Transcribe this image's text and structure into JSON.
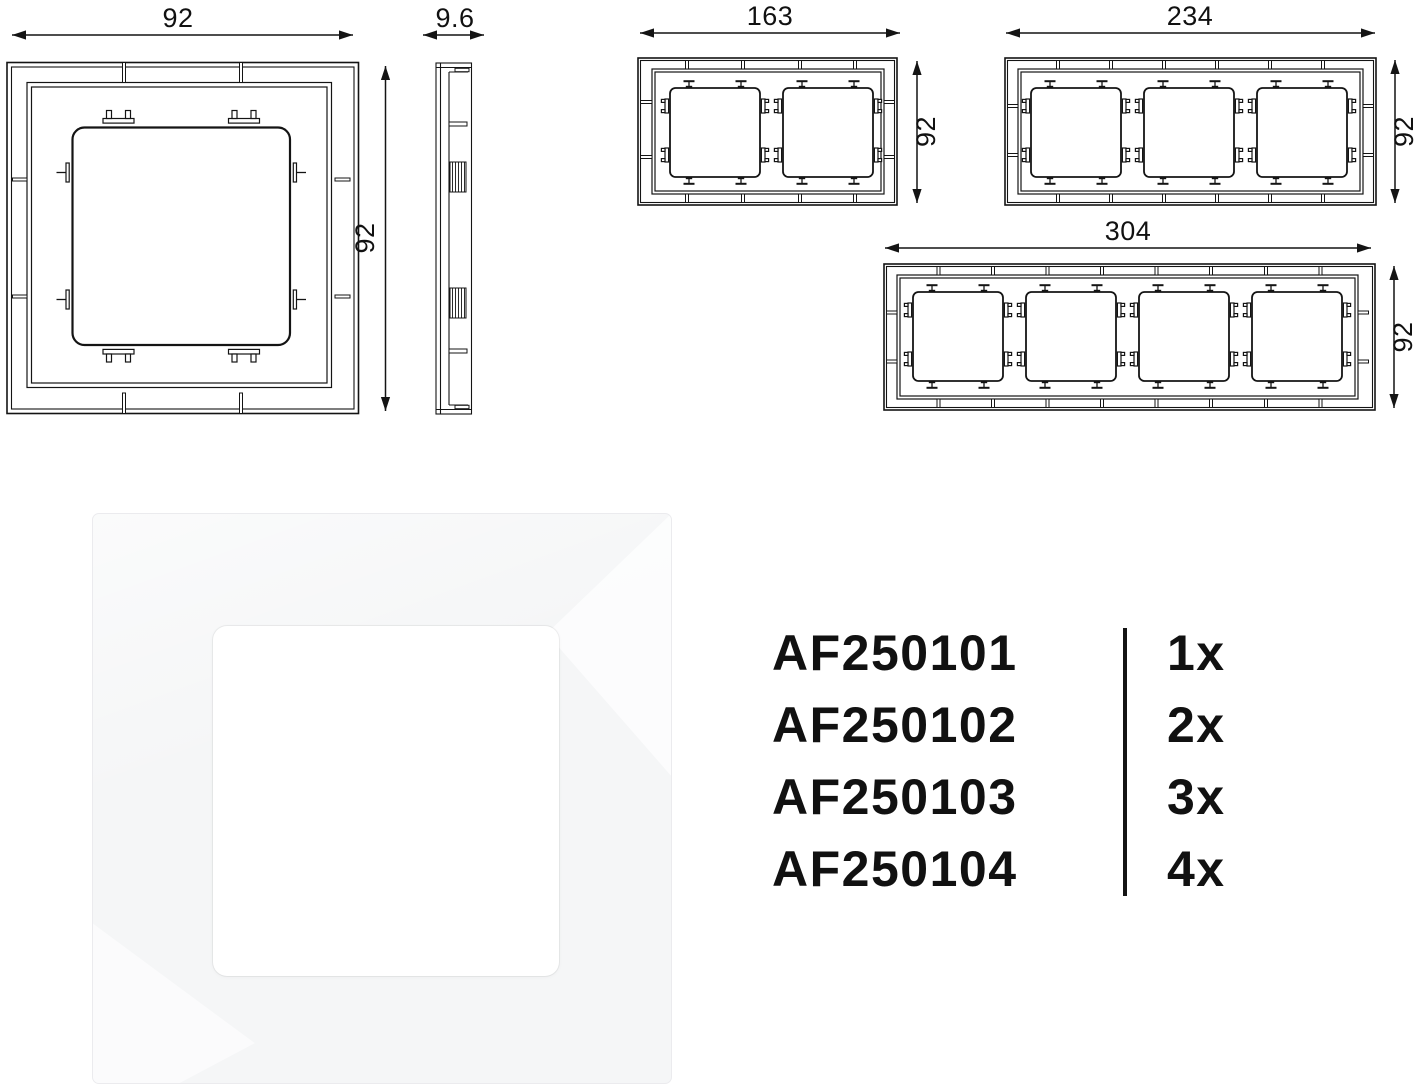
{
  "drawings": {
    "front_1g": {
      "title": "1-gang frame front view",
      "width_label": "92",
      "height_label": "92"
    },
    "side": {
      "title": "frame side profile",
      "depth_label": "9.6"
    },
    "front_2g": {
      "title": "2-gang frame front view",
      "width_label": "163",
      "height_label": "92"
    },
    "front_3g": {
      "title": "3-gang frame front view",
      "width_label": "234",
      "height_label": "92"
    },
    "front_4g": {
      "title": "4-gang frame front view",
      "width_label": "304",
      "height_label": "92"
    }
  },
  "order_table": {
    "rows": [
      {
        "code": "AF250101",
        "quantity": "1x"
      },
      {
        "code": "AF250102",
        "quantity": "2x"
      },
      {
        "code": "AF250103",
        "quantity": "3x"
      },
      {
        "code": "AF250104",
        "quantity": "4x"
      }
    ]
  },
  "colors": {
    "line": "#141414",
    "text": "#111111",
    "frame-base": "#f5f6f7",
    "frame-highlight": "#fdfdfe",
    "opening-white": "#ffffff",
    "background": "#ffffff"
  }
}
